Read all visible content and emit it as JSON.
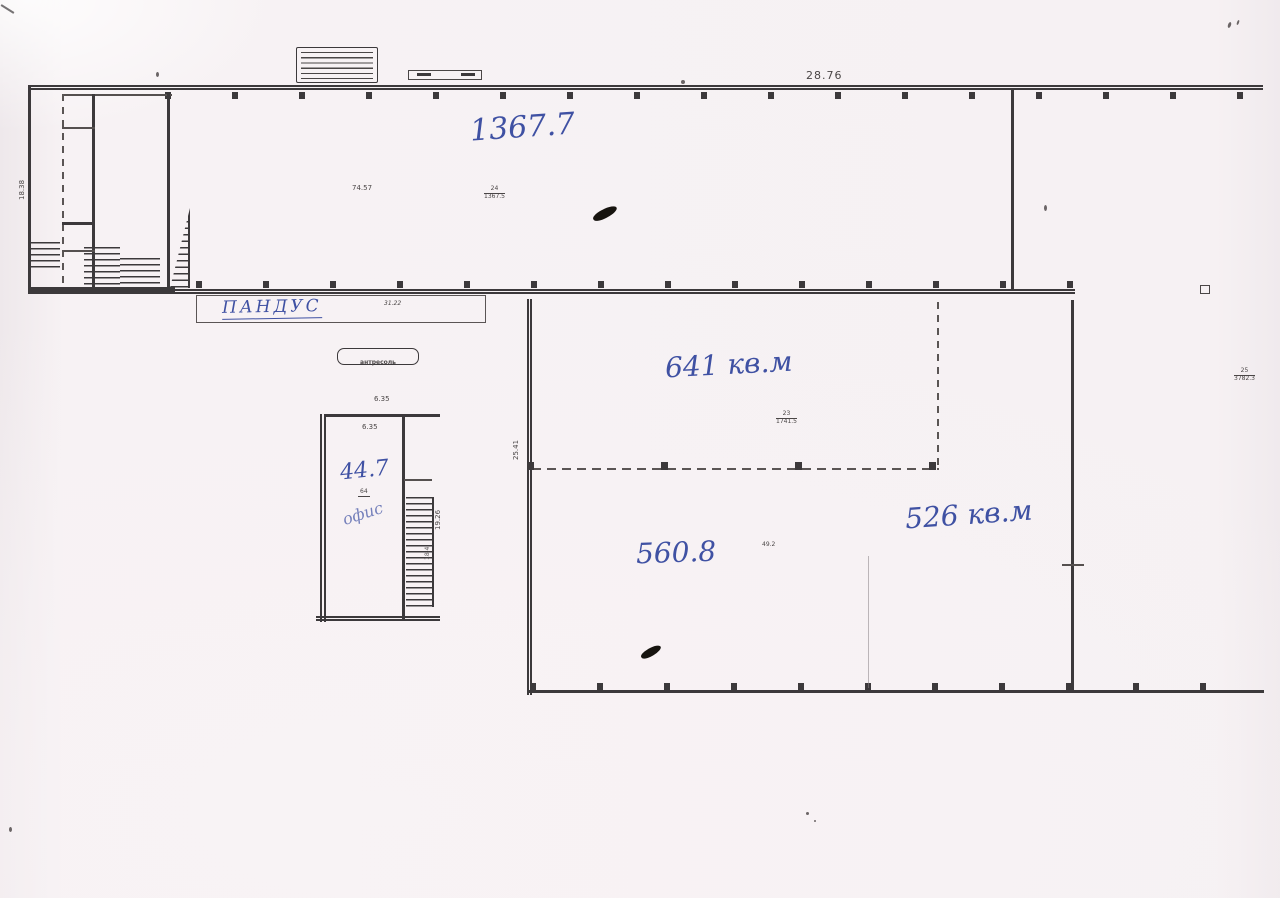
{
  "plan": {
    "paper_color": "#f6f1f3",
    "line_color": "#3c393b",
    "ink_color": "#3f51a3"
  },
  "handwritten": {
    "hall_area": "1367.7",
    "ramp_label": "ПАНДУС",
    "office_number": "44.7",
    "office_label": "офис",
    "area_mid": "641 кв.м",
    "area_right": "526 кв.м",
    "area_left": "560.8"
  },
  "printed": {
    "top_length": "28.76",
    "hall_inner_dim": "74.57",
    "hall_room_no": "24",
    "hall_room_area": "1367.5",
    "hall_width": "18.38",
    "ramp_length": "31.22",
    "mezzanine_label": "антресоль",
    "office_width_top": "6.35",
    "office_width_inner": "6.35",
    "office_room_no": "64",
    "office_depth": "19.26",
    "office_inner_dim": "18.4",
    "hall2_height": "25.41",
    "hall2_room_no": "23",
    "hall2_room_area": "1741.5",
    "hall2_inner_dim": "49.2",
    "right_room_no": "25",
    "right_room_area": "3782.3"
  }
}
